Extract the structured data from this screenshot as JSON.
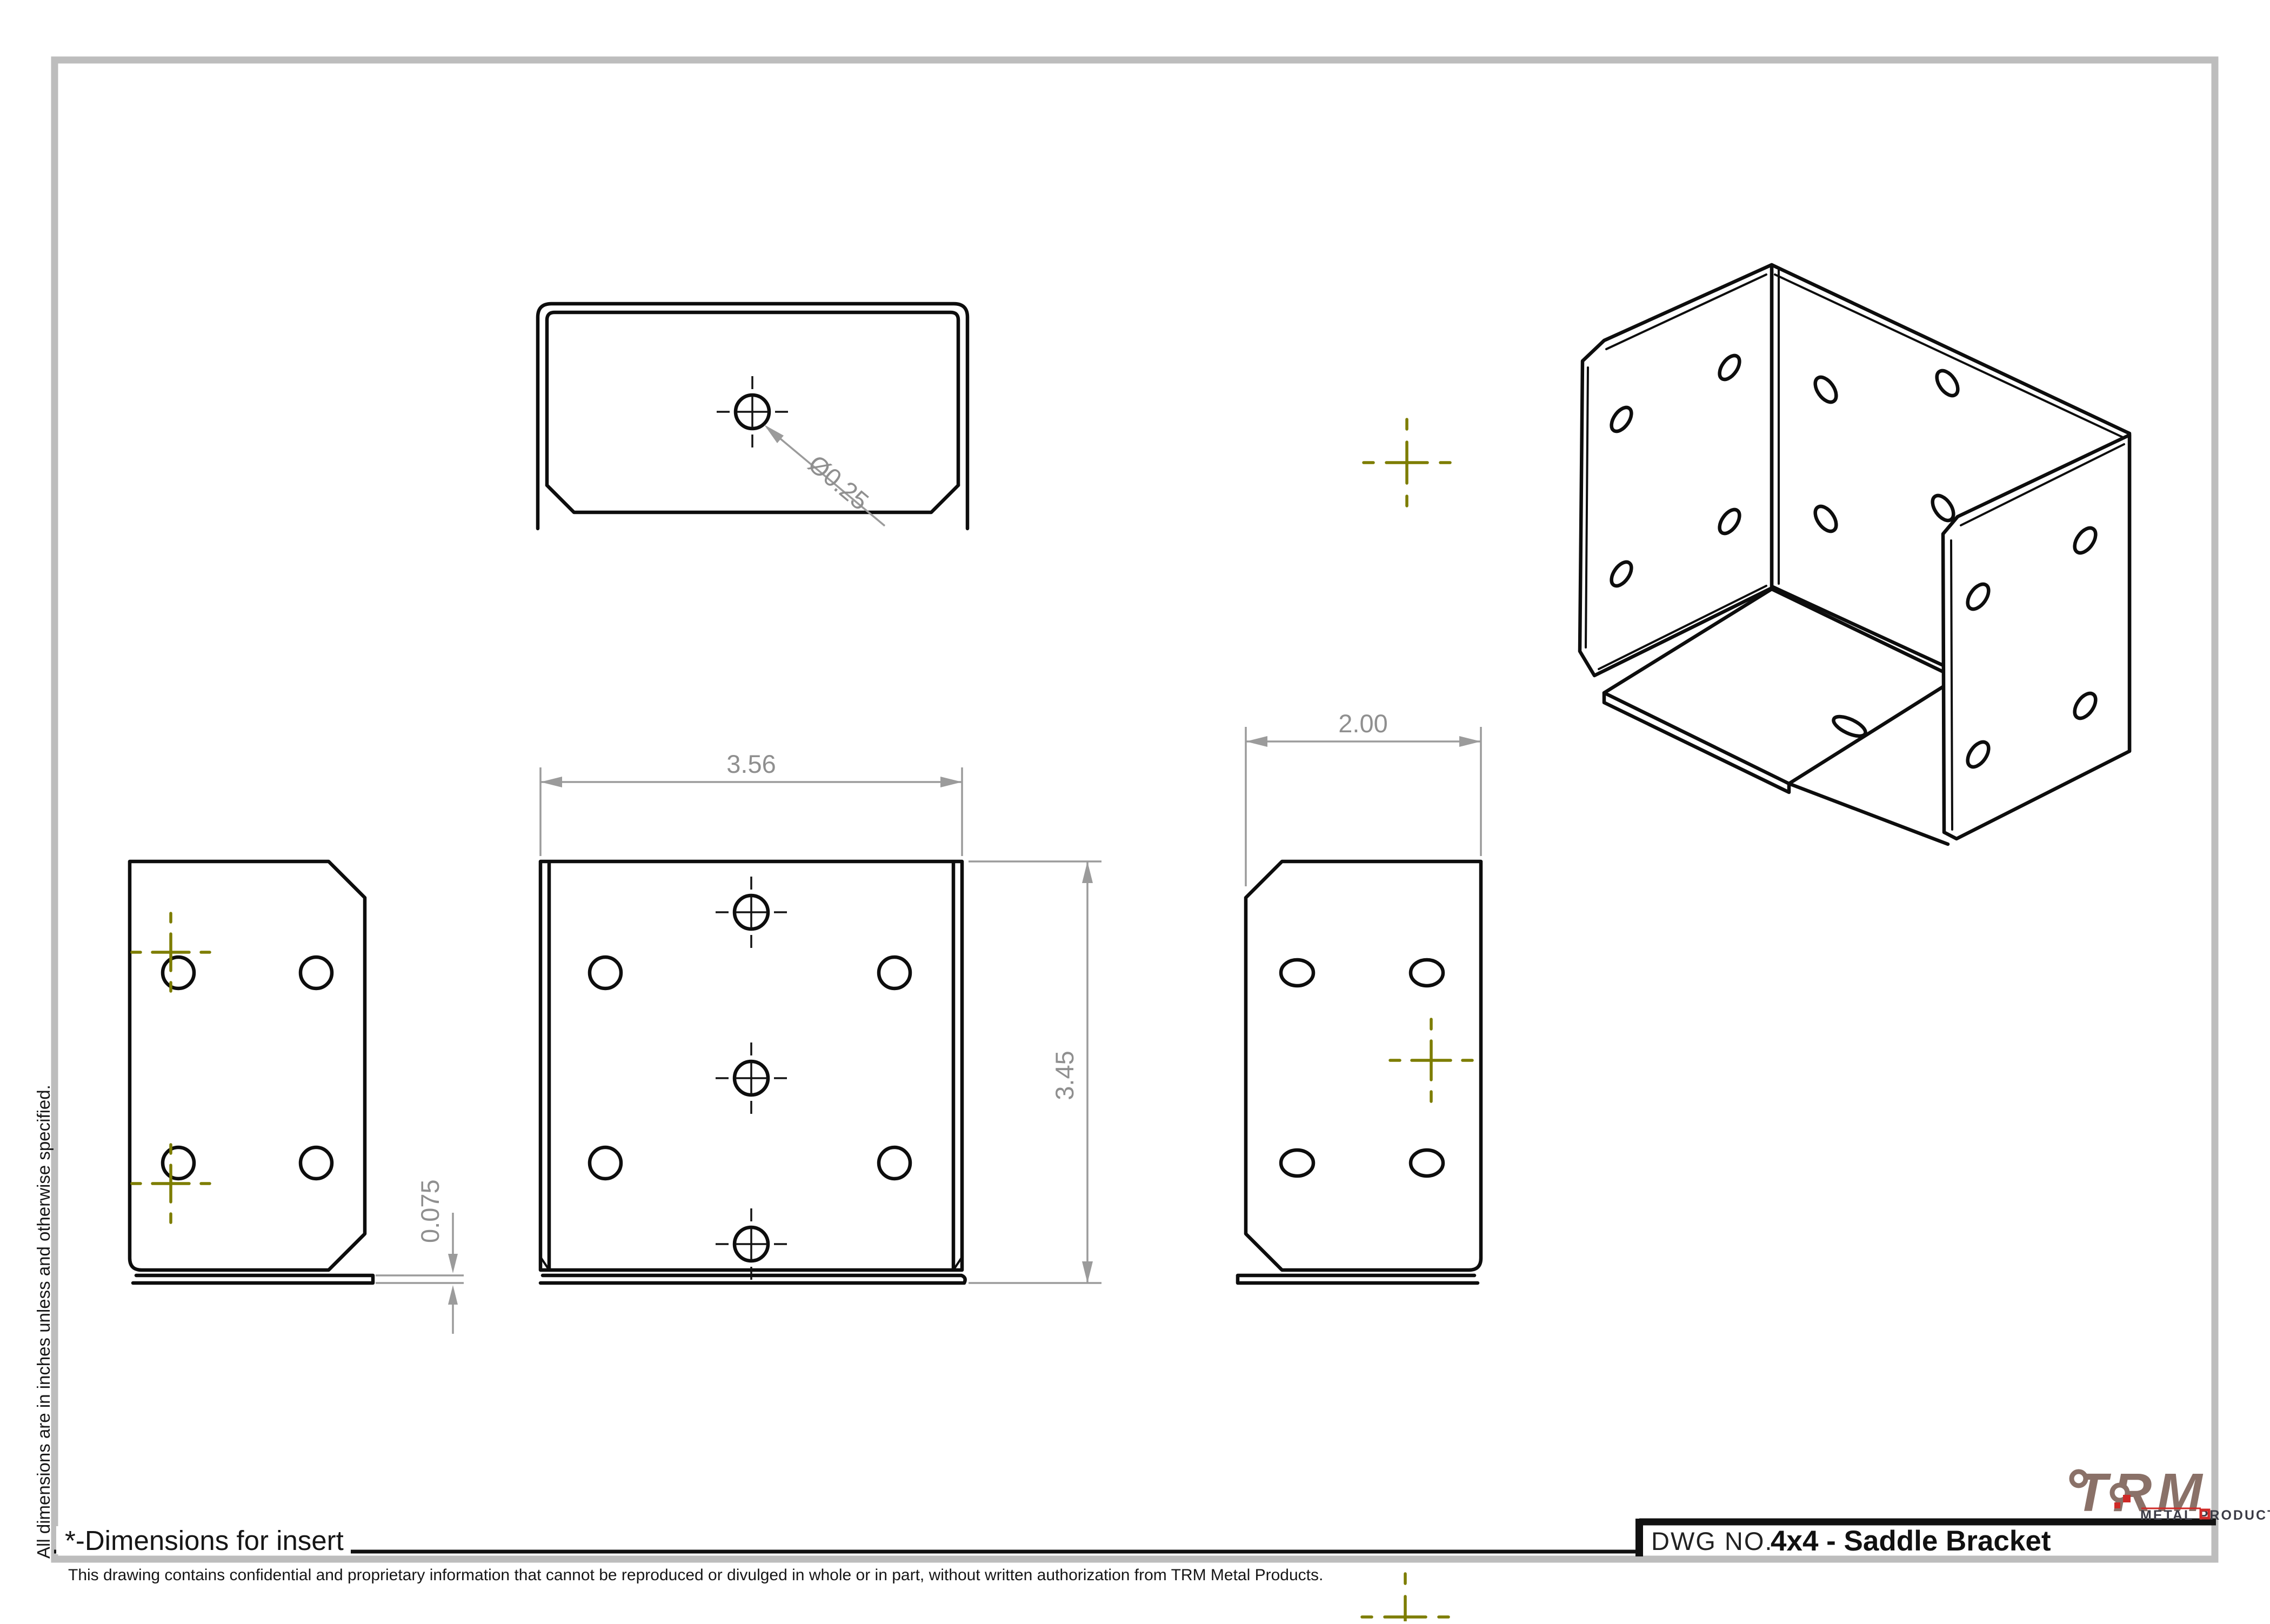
{
  "sheet": {
    "margin_note_vertical": "All dimensions are in inches unless and otherwise specified.",
    "insert_note": "*-Dimensions for insert",
    "confidentiality_note": "This drawing contains confidential and proprietary information that cannot be reproduced or divulged in whole or in part, without written authorization from TRM Metal Products."
  },
  "title_block": {
    "dwg_no_label": "DWG NO.",
    "drawing_title": "4x4 - Saddle Bracket"
  },
  "logo": {
    "brand": "TRM",
    "tagline": "METAL PRODUCTS"
  },
  "dimensions": {
    "hole_diameter": "Ø0.25",
    "plate_width": "3.56",
    "plate_height": "3.45",
    "side_depth": "2.00",
    "flange_thickness": "0.075"
  },
  "colors": {
    "part_line": "#0d0d0d",
    "dimension": "#9b9b9b",
    "sketch_point": "#7d7d00",
    "frame": "#bdbdbd",
    "logo_brand": "#8a7168",
    "logo_accent": "#cf2a27",
    "logo_tagline": "#3b3b46"
  }
}
